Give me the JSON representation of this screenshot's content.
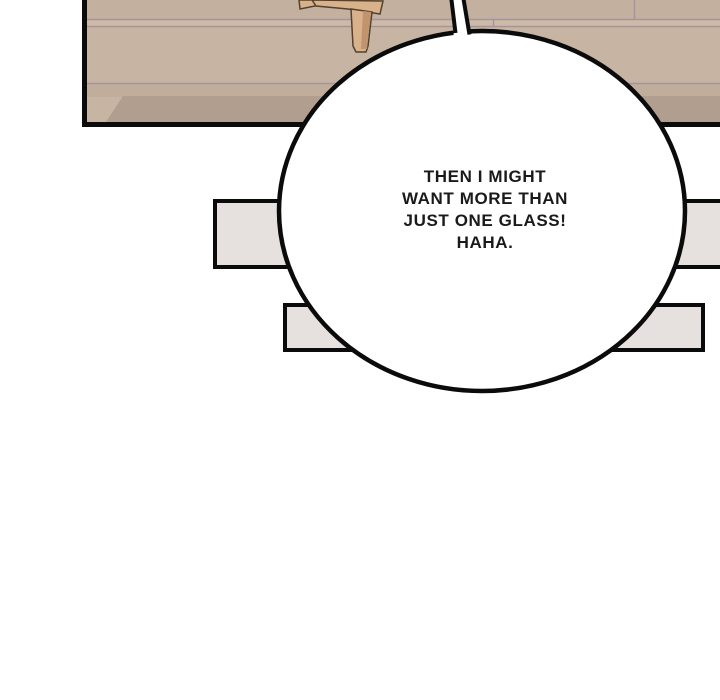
{
  "comic": {
    "panel": {
      "colors": {
        "outline": "#0b0b0b",
        "floor_main": "#c7b4a2",
        "floor_top": "#c3b09e",
        "floor_light_strip": "#cdbaa8",
        "floor_mid_strip": "#c0ad9b",
        "floor_dark_band": "#b19e8e",
        "plank_line": "#a39599",
        "wood_light": "#d9b28b",
        "wood_dark": "#c1946d",
        "wood_outline": "#54412e"
      }
    },
    "background_rects": {
      "fill": "#e6e0df",
      "outline": "#0b0b0b"
    },
    "speech_bubble": {
      "fill": "#ffffff",
      "outline": "#0b0b0b",
      "text_color": "#1a1a1a",
      "lines": {
        "0": "THEN I MIGHT",
        "1": "WANT MORE THAN",
        "2": "JUST ONE GLASS!",
        "3": "HAHA."
      }
    }
  }
}
